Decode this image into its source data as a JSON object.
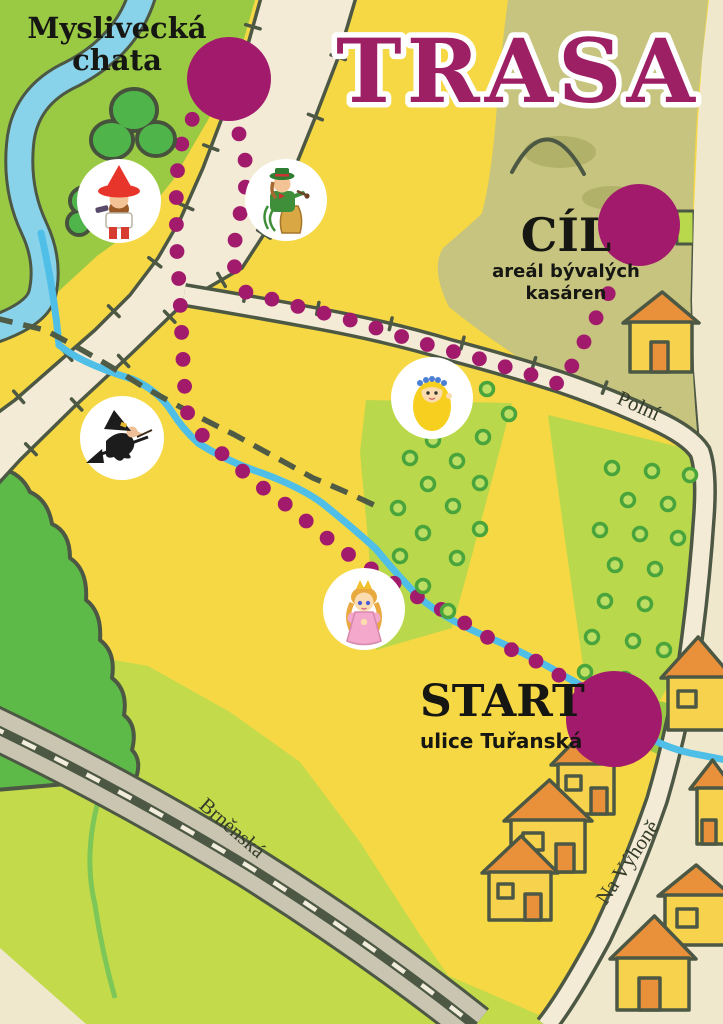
{
  "title": "TRASA",
  "markers": {
    "chata": {
      "label_line1": "Myslivecká",
      "label_line2": "chata",
      "x": 229,
      "y": 79,
      "r": 42
    },
    "cil": {
      "label": "CÍL",
      "sublabel": "areál bývalých kasáren",
      "x": 639,
      "y": 225,
      "r": 41
    },
    "start": {
      "label": "START",
      "sublabel": "ulice Tuřanská",
      "x": 614,
      "y": 719,
      "r": 48
    }
  },
  "streets": [
    {
      "name": "Brněnská",
      "x": 228,
      "y": 833,
      "angle": 41
    },
    {
      "name": "Polní",
      "x": 636,
      "y": 412,
      "angle": 24
    },
    {
      "name": "Na Výhoně",
      "x": 633,
      "y": 866,
      "angle": -56
    }
  ],
  "stations": [
    {
      "id": "bandit",
      "character": "loupežník s červeným kloboukem",
      "x": 119,
      "y": 201
    },
    {
      "id": "vodnik",
      "character": "vodník na pařezu",
      "x": 286,
      "y": 200
    },
    {
      "id": "witch",
      "character": "čarodějnice na koštěti",
      "x": 122,
      "y": 438
    },
    {
      "id": "vila",
      "character": "víla s dlouhými vlasy",
      "x": 432,
      "y": 398
    },
    {
      "id": "princezna",
      "character": "princezna",
      "x": 364,
      "y": 609
    }
  ],
  "trail": {
    "color": "#a21a6b",
    "dot_radius": 7.4,
    "spacing": 27,
    "segments": [
      [
        [
          585,
          692
        ],
        [
          540,
          663
        ],
        [
          495,
          642
        ],
        [
          452,
          615
        ],
        [
          408,
          592
        ],
        [
          362,
          563
        ],
        [
          337,
          547
        ],
        [
          318,
          530
        ],
        [
          297,
          514
        ],
        [
          278,
          498
        ],
        [
          254,
          482
        ],
        [
          236,
          465
        ],
        [
          215,
          448
        ],
        [
          198,
          431
        ],
        [
          186,
          410
        ],
        [
          183,
          360
        ],
        [
          180,
          300
        ],
        [
          177,
          252
        ],
        [
          176,
          205
        ],
        [
          178,
          160
        ],
        [
          184,
          135
        ],
        [
          196,
          112
        ]
      ],
      [
        [
          238,
          130
        ],
        [
          245,
          158
        ],
        [
          246,
          184
        ],
        [
          241,
          209
        ],
        [
          236,
          233
        ],
        [
          233,
          257
        ],
        [
          237,
          283
        ]
      ],
      [
        [
          242,
          291
        ],
        [
          300,
          307
        ],
        [
          358,
          322
        ],
        [
          418,
          342
        ],
        [
          477,
          358
        ],
        [
          535,
          376
        ],
        [
          562,
          385
        ],
        [
          576,
          358
        ],
        [
          588,
          334
        ],
        [
          599,
          312
        ],
        [
          610,
          290
        ],
        [
          618,
          271
        ]
      ]
    ]
  },
  "orchards": [
    {
      "dots": [
        [
          487,
          389
        ],
        [
          460,
          403
        ],
        [
          509,
          414
        ],
        [
          433,
          440
        ],
        [
          483,
          437
        ],
        [
          410,
          458
        ],
        [
          457,
          461
        ],
        [
          480,
          483
        ],
        [
          428,
          484
        ],
        [
          398,
          508
        ],
        [
          453,
          506
        ],
        [
          480,
          529
        ],
        [
          423,
          533
        ],
        [
          400,
          556
        ],
        [
          457,
          558
        ],
        [
          423,
          586
        ],
        [
          448,
          611
        ]
      ]
    },
    {
      "dots": [
        [
          612,
          468
        ],
        [
          652,
          471
        ],
        [
          690,
          475
        ],
        [
          628,
          500
        ],
        [
          668,
          504
        ],
        [
          600,
          530
        ],
        [
          640,
          534
        ],
        [
          678,
          538
        ],
        [
          615,
          565
        ],
        [
          655,
          569
        ],
        [
          605,
          601
        ],
        [
          645,
          604
        ],
        [
          592,
          637
        ],
        [
          633,
          641
        ],
        [
          664,
          650
        ],
        [
          585,
          672
        ],
        [
          625,
          679
        ]
      ]
    }
  ],
  "houses": [
    {
      "x": 630,
      "y": 322,
      "w": 62,
      "h": 50,
      "rh": 30,
      "door": {
        "dx": 21,
        "w": 17,
        "h": 30
      }
    },
    {
      "x": 668,
      "y": 677,
      "w": 58,
      "h": 53,
      "rh": 40,
      "window": {
        "dx": 10,
        "dy": 14,
        "w": 18,
        "h": 16
      }
    },
    {
      "x": 558,
      "y": 764,
      "w": 56,
      "h": 50,
      "rh": 36,
      "door": {
        "dx": 33,
        "w": 16,
        "h": 26
      },
      "window": {
        "dx": 8,
        "dy": 12,
        "w": 15,
        "h": 14
      }
    },
    {
      "x": 697,
      "y": 788,
      "w": 30,
      "h": 56,
      "rh": 28,
      "door": {
        "dx": 5,
        "w": 14,
        "h": 24
      }
    },
    {
      "x": 511,
      "y": 820,
      "w": 74,
      "h": 52,
      "rh": 40,
      "door": {
        "dx": 45,
        "w": 18,
        "h": 28
      },
      "window": {
        "dx": 12,
        "dy": 13,
        "w": 20,
        "h": 17
      }
    },
    {
      "x": 489,
      "y": 872,
      "w": 62,
      "h": 48,
      "rh": 36,
      "door": {
        "dx": 36,
        "w": 16,
        "h": 26
      },
      "window": {
        "dx": 9,
        "dy": 12,
        "w": 15,
        "h": 14
      }
    },
    {
      "x": 665,
      "y": 895,
      "w": 60,
      "h": 50,
      "rh": 30,
      "window": {
        "dx": 12,
        "dy": 14,
        "w": 20,
        "h": 18
      }
    },
    {
      "x": 617,
      "y": 958,
      "w": 72,
      "h": 52,
      "rh": 42,
      "door": {
        "dx": 22,
        "w": 21,
        "h": 32
      }
    }
  ],
  "palette": {
    "paper": "#f0e8cd",
    "yellow": "#f6d844",
    "meadow": "#9aca44",
    "bush": "#4fb44a",
    "forest": "#5eba48",
    "field_light": "#c3da4b",
    "orchard": "#b9d84b",
    "khaki": "#c6c47e",
    "khaki_shade": "#b2b169",
    "outline": "#4c5844",
    "road_fill": "#f3ebd6",
    "brn_fill": "#c9c5b1",
    "river": "#88d2ea",
    "stream": "#50bfe8",
    "magenta": "#a21a6b",
    "house_wall": "#f7d34d",
    "house_roof": "#e8903a",
    "ring_stroke": "#49a43b",
    "ring_fill": "#bcdf63"
  }
}
